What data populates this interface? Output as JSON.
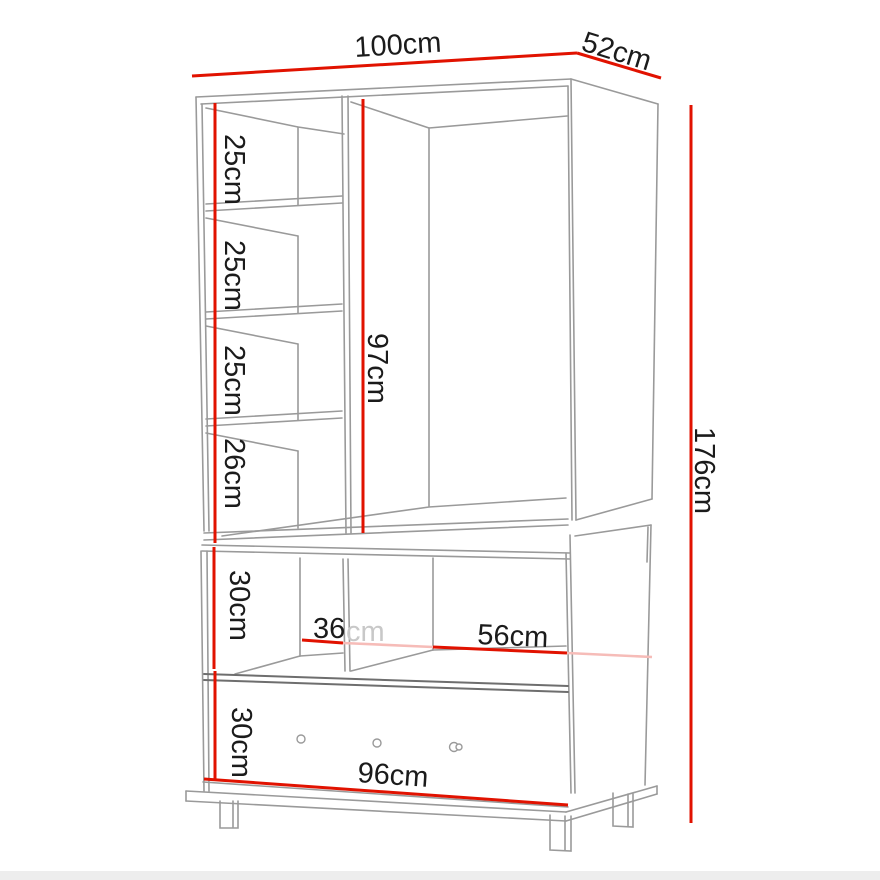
{
  "diagram": {
    "name": "Wardrobe dimension diagram",
    "unit": "cm",
    "overall": {
      "width": "100cm",
      "depth": "52cm",
      "height": "176cm"
    },
    "labels": {
      "top_width": "100cm",
      "top_depth": "52cm",
      "right_height": "176cm",
      "hanging_section_height": "97cm",
      "shelf_gap_1": "25cm",
      "shelf_gap_2": "25cm",
      "shelf_gap_3": "25cm",
      "shelf_gap_4": "26cm",
      "open_shelf_height": "30cm",
      "drawer_height": "30cm",
      "open_left_width_number": "36",
      "open_left_width_unit": "cm",
      "open_right_width": "56cm",
      "bottom_width": "96cm"
    },
    "colors": {
      "dimension": "#e11200",
      "dimension_faded": "#f6bcb8",
      "structure": "#9a9a9a",
      "structure_dark": "#6e6e6e",
      "text": "#1b1b1b",
      "text_faded": "#c8c8c8",
      "floor_strip": "#ededed"
    }
  }
}
